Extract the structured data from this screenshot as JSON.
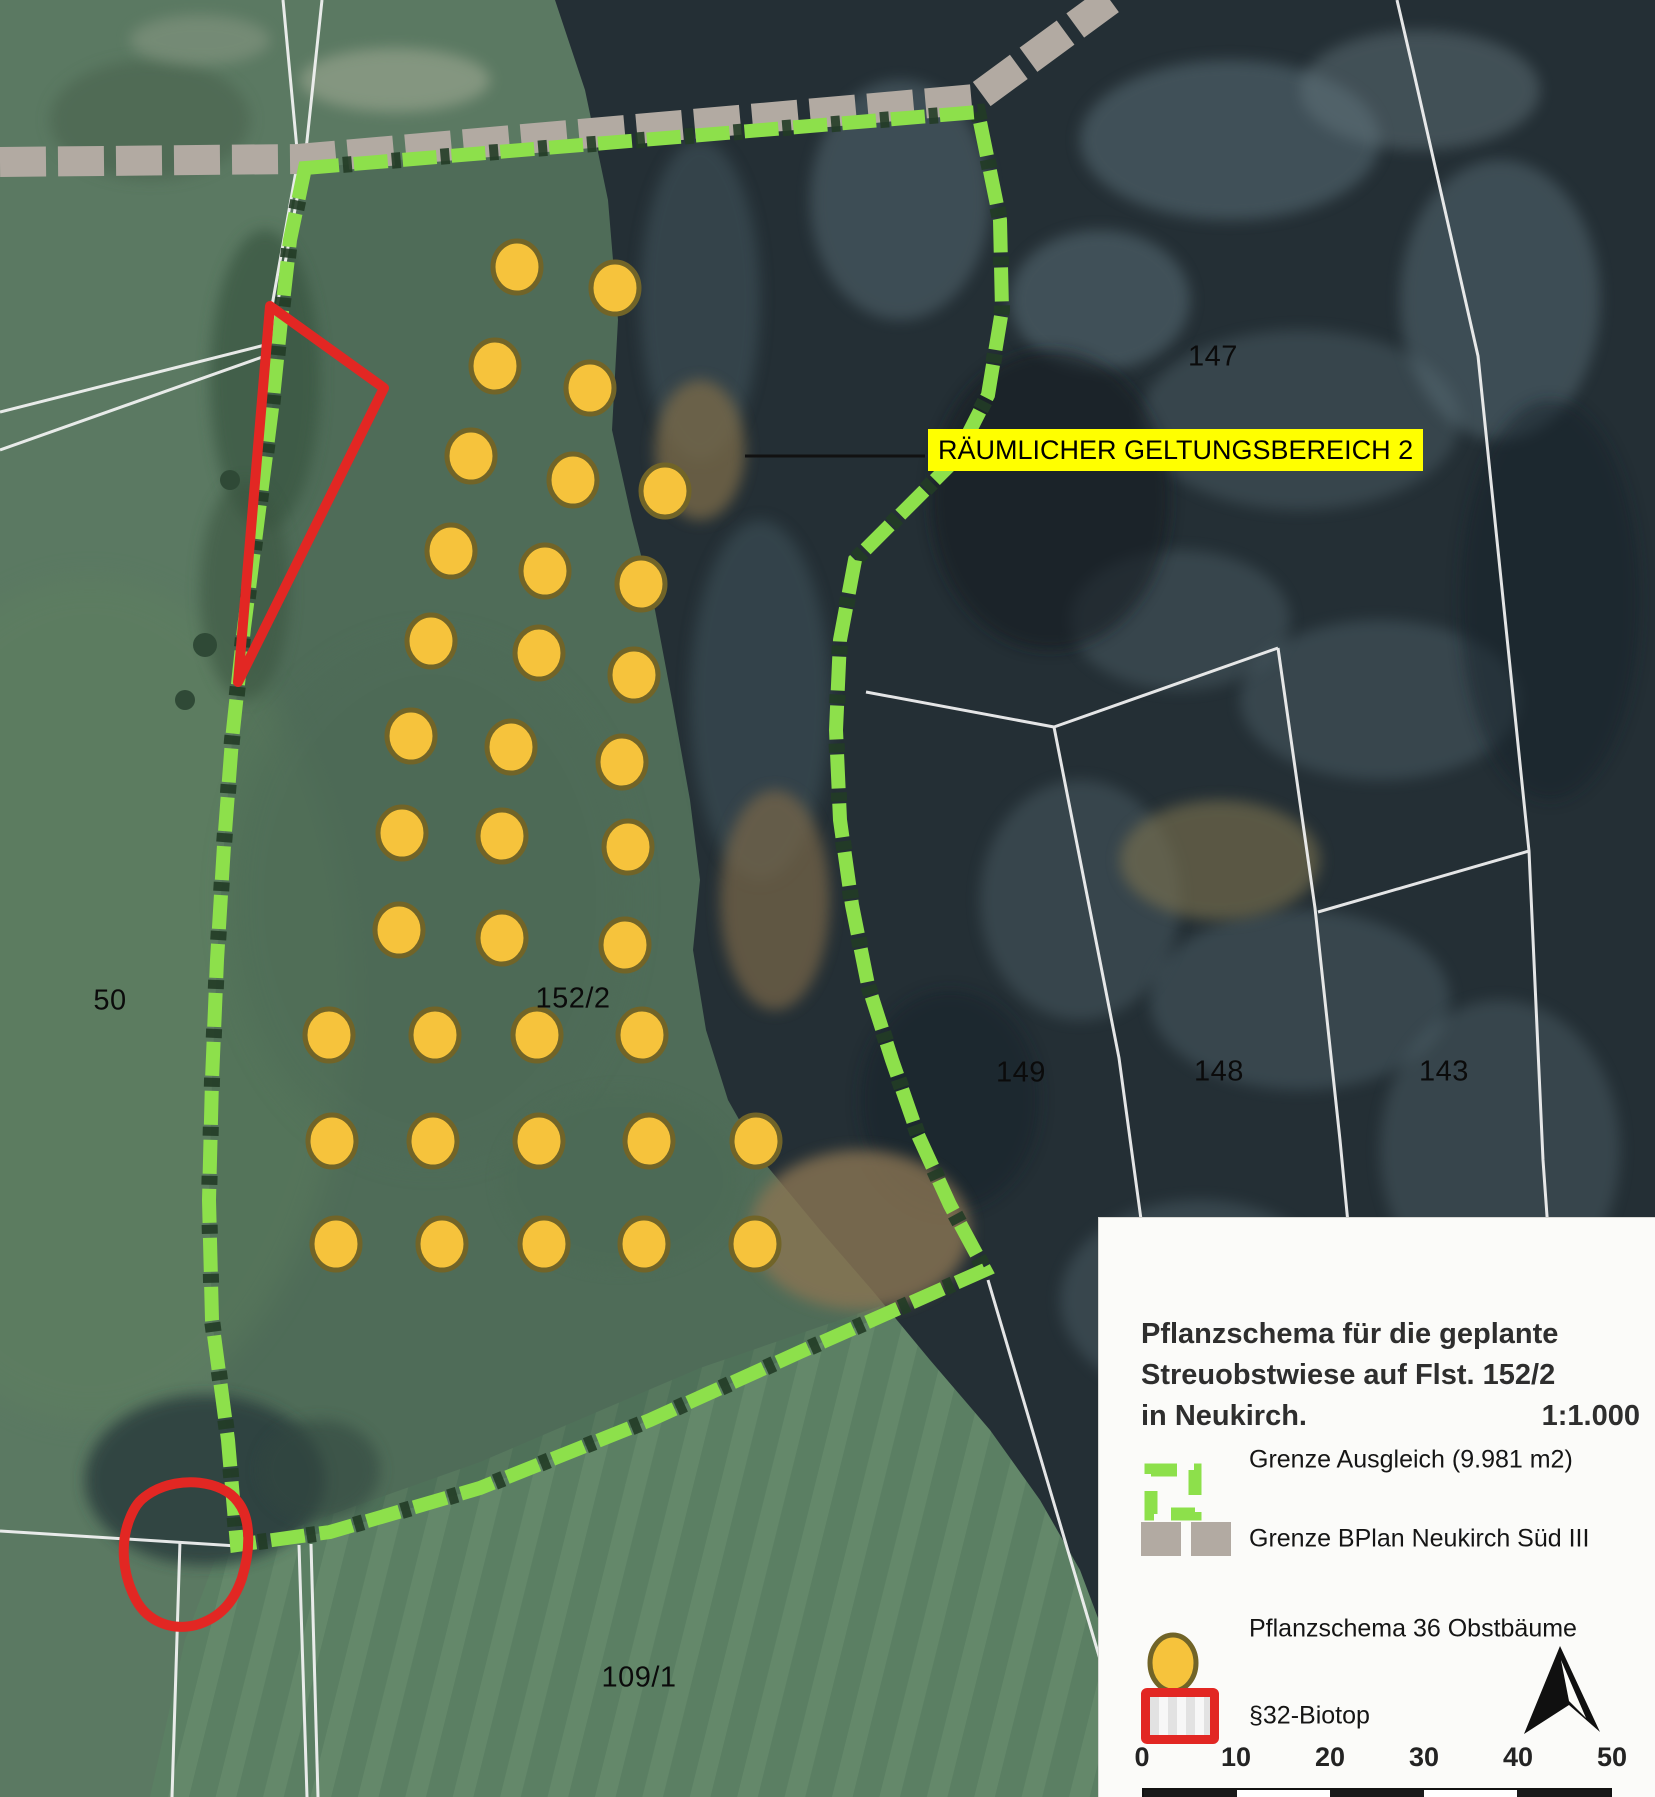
{
  "map": {
    "callout": {
      "text": "RÄUMLICHER GELTUNGSBEREICH 2"
    },
    "parcel_labels": [
      {
        "text": "50",
        "x": 110,
        "y": 1001
      },
      {
        "text": "152/2",
        "x": 573,
        "y": 999
      },
      {
        "text": "147",
        "x": 1213,
        "y": 357
      },
      {
        "text": "149",
        "x": 1021,
        "y": 1073
      },
      {
        "text": "148",
        "x": 1219,
        "y": 1072
      },
      {
        "text": "143",
        "x": 1444,
        "y": 1072
      },
      {
        "text": "109/1",
        "x": 639,
        "y": 1678
      }
    ],
    "tree_count": 36,
    "tree_positions": [
      [
        517,
        267
      ],
      [
        615,
        288
      ],
      [
        495,
        366
      ],
      [
        590,
        388
      ],
      [
        471,
        456
      ],
      [
        573,
        480
      ],
      [
        665,
        491
      ],
      [
        451,
        551
      ],
      [
        545,
        571
      ],
      [
        641,
        584
      ],
      [
        431,
        641
      ],
      [
        539,
        653
      ],
      [
        634,
        675
      ],
      [
        411,
        736
      ],
      [
        511,
        747
      ],
      [
        622,
        762
      ],
      [
        402,
        833
      ],
      [
        502,
        836
      ],
      [
        628,
        847
      ],
      [
        399,
        930
      ],
      [
        502,
        938
      ],
      [
        625,
        945
      ],
      [
        329,
        1035
      ],
      [
        435,
        1035
      ],
      [
        537,
        1035
      ],
      [
        642,
        1035
      ],
      [
        332,
        1141
      ],
      [
        433,
        1141
      ],
      [
        539,
        1141
      ],
      [
        649,
        1141
      ],
      [
        756,
        1141
      ],
      [
        336,
        1244
      ],
      [
        442,
        1244
      ],
      [
        544,
        1244
      ],
      [
        644,
        1244
      ],
      [
        755,
        1244
      ]
    ],
    "colors": {
      "boundary_green": "#8de04b",
      "bplan_gray": "#b2aaa2",
      "tree_yellow": "#f6c33c",
      "biotop_red": "#e22723",
      "callout_bg": "#ffff00",
      "parcel_line_white": "#f5f5f5"
    }
  },
  "legend": {
    "title_lines": [
      "Pflanzschema für die geplante",
      "Streuobstwiese auf Flst. 152/2",
      "in Neukirch."
    ],
    "scale_text": "1:1.000",
    "items": [
      {
        "key": "grenze-ausgleich",
        "label": "Grenze Ausgleich (9.981 m2)"
      },
      {
        "key": "grenze-bplan",
        "label": "Grenze BPlan Neukirch Süd III"
      },
      {
        "key": "pflanzschema",
        "label": "Pflanzschema 36 Obstbäume"
      },
      {
        "key": "biotop",
        "label": "§32-Biotop"
      }
    ],
    "scalebar": {
      "ticks": [
        "0",
        "10",
        "20",
        "30",
        "40",
        "50"
      ],
      "segment_colors": [
        "#1a1a1a",
        "#ffffff",
        "#1a1a1a",
        "#ffffff",
        "#1a1a1a"
      ]
    }
  }
}
